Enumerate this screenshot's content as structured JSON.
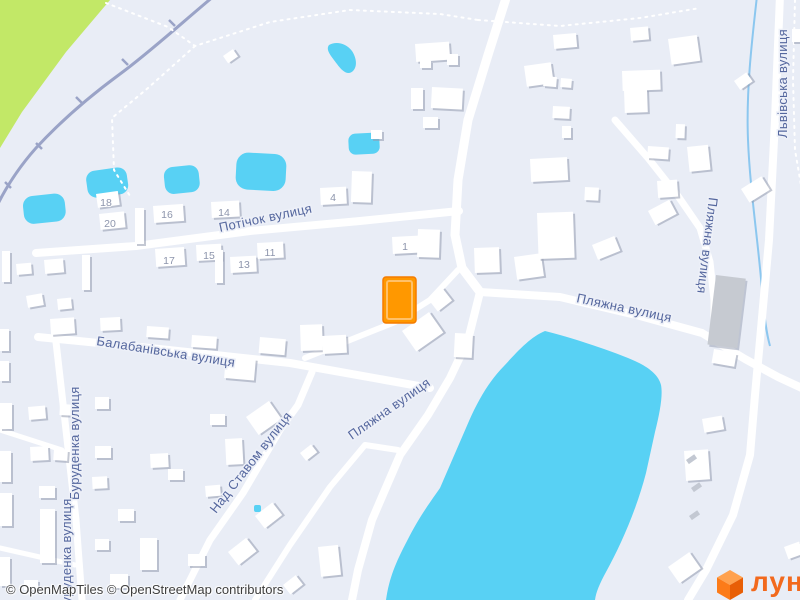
{
  "map": {
    "street_labels": {
      "potichok": "Потічок вулиця",
      "balabanivska": "Балабанівська вулиця",
      "burudenka": "Буруденка вулиця",
      "nad_stavom": "Над Ставом вулиця",
      "plyazhna": "Пляжна вулиця",
      "lvivska": "Львівська вулиця"
    },
    "house_numbers": [
      "18",
      "20",
      "16",
      "14",
      "4",
      "17",
      "15",
      "13",
      "11",
      "1"
    ],
    "colors": {
      "highlight": "#FF9800",
      "highlight_stroke": "#F57C00",
      "water": "#58D1F4",
      "park": "#C2E867",
      "road": "#FFFFFF",
      "background": "#E9EDF6",
      "railway": "#9AA3C7",
      "label": "#55679E"
    }
  },
  "attribution": {
    "text": "© OpenMapTiles © OpenStreetMap contributors"
  },
  "logo": {
    "text": "лун"
  }
}
